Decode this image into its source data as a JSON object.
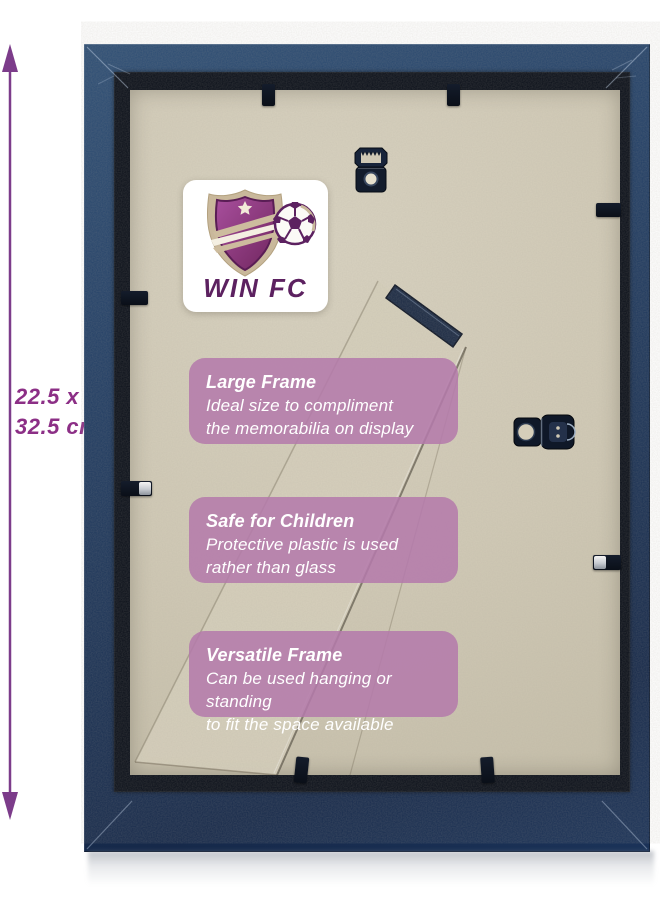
{
  "product_photo": {
    "description": "back-of-picture-frame-product-photo",
    "dimension_annotation": {
      "line1": "22.5 x",
      "line2": "32.5 cm"
    },
    "logo": {
      "club_name": "WIN FC"
    },
    "info_boxes": [
      {
        "title": "Large Frame",
        "line1": "Ideal size to compliment",
        "line2": "the memorabilia on display"
      },
      {
        "title": "Safe for Children",
        "line1": "Protective plastic is used",
        "line2": "rather than glass"
      },
      {
        "title": "Versatile Frame",
        "line1": "Can be used hanging or standing",
        "line2": "to fit the space available"
      }
    ],
    "hardware": [
      "sawtooth-hanger",
      "side-dring-hanger",
      "easel-stand",
      "backing-clip-top-left",
      "backing-clip-top-right",
      "backing-clip-left-upper",
      "backing-clip-left-lower",
      "backing-clip-right-upper",
      "backing-clip-right-lower",
      "backing-clip-bottom-left",
      "backing-clip-bottom-right"
    ]
  },
  "colors": {
    "frame_navy_light": "#2d4e75",
    "frame_navy": "#1e3a5e",
    "frame_navy_dark": "#152844",
    "lip_black": "#0a0f19",
    "backing_tan": "#d1cab6",
    "box_mauve": "#b47aabdd",
    "brand_purple": "#5c2160",
    "brand_tan": "#c9b89b",
    "dimension_purple": "#8c2f86",
    "arrow_purple": "#7c3c8a",
    "text_white": "#ffffff"
  }
}
